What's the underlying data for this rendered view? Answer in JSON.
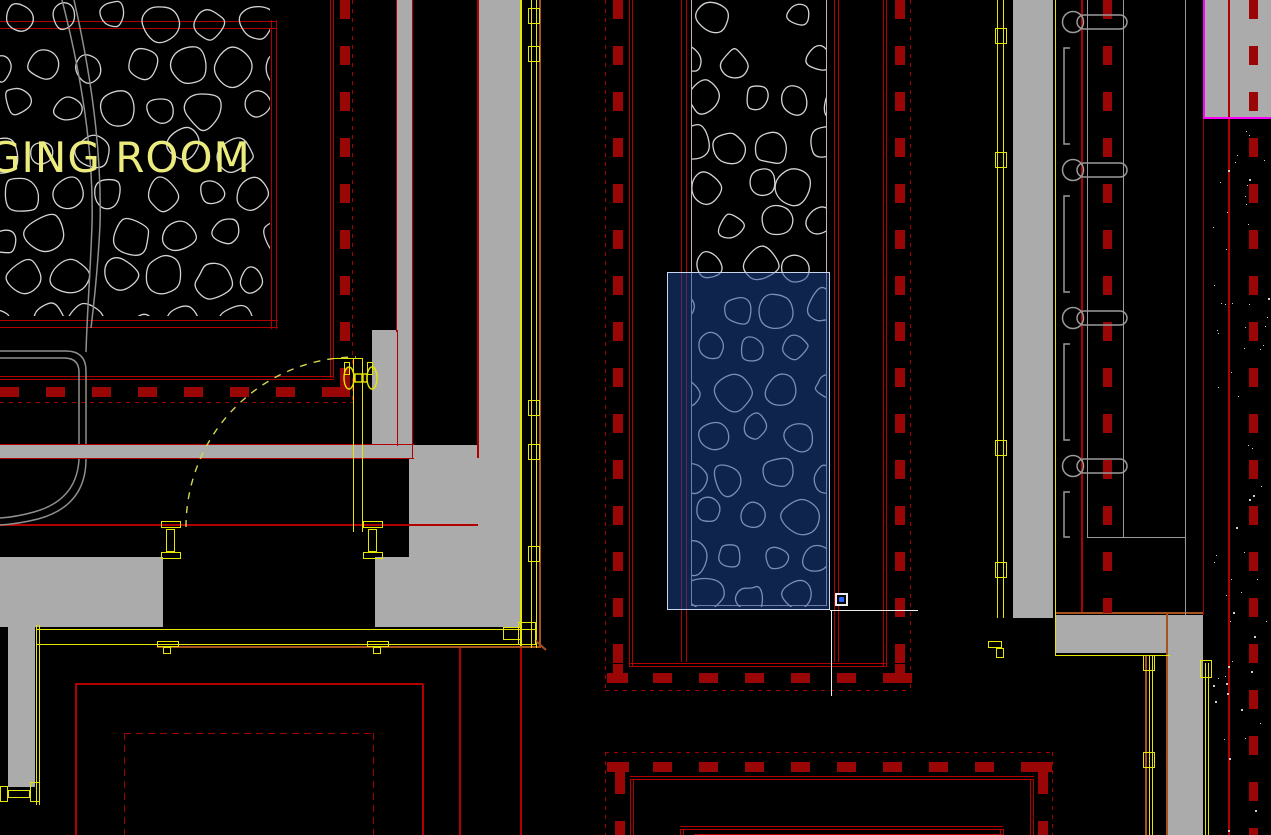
{
  "drawing": {
    "room_label": "GING ROOM",
    "palette": {
      "background": "#000000",
      "wall_gray": "#ababab",
      "line_red": "#b20000",
      "dash_red": "#9a0606",
      "dot_red": "#a30000",
      "rust": "#a9501f",
      "yellow": "#e6e600",
      "text_yellow": "#ecec7e",
      "arc_yellow": "#d6d64e",
      "stone_gray": "#d4d4d4",
      "bench_gray": "#8f8f8f",
      "fixture_gray": "#9a9a9a",
      "band_border": "#c8b2b2",
      "magenta": "#ff00ff",
      "selection_fill": "rgba(28,72,152,0.5)",
      "selection_border": "#c9d5ec",
      "crosshair_white": "#ededed",
      "pickbox_blue": "#2d6bff",
      "stipple_white": "#cfcfcf"
    },
    "stone_hatches": [
      {
        "name": "room-floor-hatch",
        "x": 0,
        "y": 0,
        "w": 270,
        "h": 316,
        "cell": 47,
        "seed": 7
      },
      {
        "name": "corridor-floor-hatch",
        "x": 692,
        "y": 0,
        "w": 134,
        "h": 607,
        "cell": 45,
        "seed": 13
      }
    ],
    "wall_hooks": {
      "count": 4,
      "first_y": 22,
      "spacing": 148
    },
    "stipple": {
      "count": 65,
      "seed": 5,
      "x": 1212,
      "y": 125,
      "w": 56,
      "h": 706
    },
    "selection_window": {
      "x": 667,
      "y": 272,
      "w": 163,
      "h": 338
    },
    "cursor": {
      "x": 830,
      "y": 610,
      "h_arm": 88,
      "v_arm": 86,
      "badge_icon": "window-selection-badge",
      "badge": {
        "x": 835,
        "y": 593,
        "size": 13
      }
    }
  }
}
